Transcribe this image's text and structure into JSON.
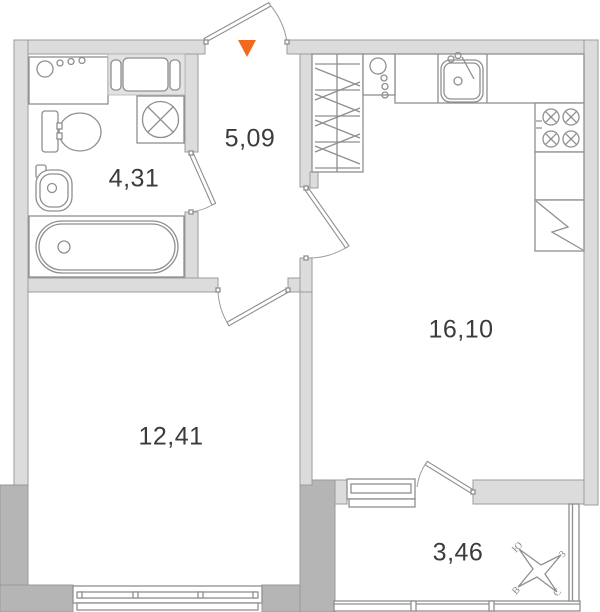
{
  "plan": {
    "rooms": {
      "bathroom": {
        "area": "4,31"
      },
      "hallway": {
        "area": "5,09"
      },
      "kitchen_living": {
        "area": "16,10"
      },
      "bedroom": {
        "area": "12,41"
      },
      "balcony": {
        "area": "3,46"
      }
    },
    "compass": {
      "north": "С",
      "south": "Ю",
      "east": "В",
      "west": "З"
    },
    "colors": {
      "wall_light": "#dcdcdc",
      "wall_dark": "#b5b5b5",
      "outline": "#8f8f8f",
      "label_text": "#3b3b3b",
      "entrance_marker": "#f2691e",
      "background": "#ffffff"
    }
  }
}
